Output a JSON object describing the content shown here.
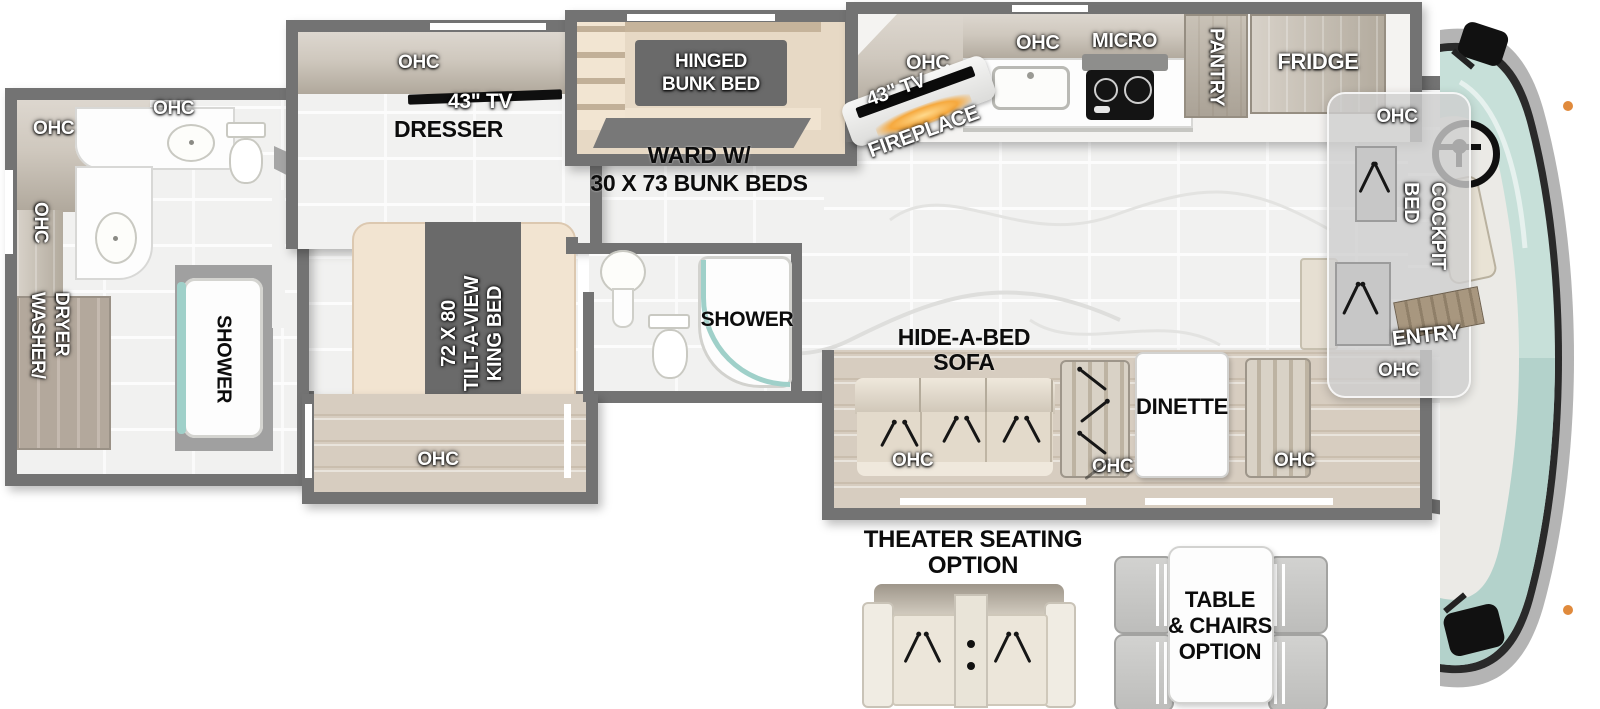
{
  "labels": {
    "ohc": "OHC",
    "tv43": "43\" TV",
    "dresser": "DRESSER",
    "hinged1": "HINGED",
    "hinged2": "BUNK BED",
    "ward1": "WARD W/",
    "ward2": "30 X 73 BUNK BEDS",
    "king1": "72 X 80",
    "king2": "TILT-A-VIEW",
    "king3": "KING BED",
    "shower": "SHOWER",
    "washer1": "WASHER/",
    "washer2": "DRYER",
    "fireplace": "FIREPLACE",
    "micro": "MICRO",
    "pantry": "PANTRY",
    "fridge": "FRIDGE",
    "sofa1": "HIDE-A-BED",
    "sofa2": "SOFA",
    "dinette": "DINETTE",
    "cockpit1": "COCKPIT",
    "cockpit2": "BED",
    "entry": "ENTRY",
    "theater1": "THEATER SEATING",
    "theater2": "OPTION",
    "table1": "TABLE",
    "table2": "& CHAIRS",
    "table3": "OPTION"
  },
  "colors": {
    "wall": "#737373",
    "tile": "#f1f1f0",
    "wood_floor": "#d7cdc0",
    "dark_box": "#6a6a6a",
    "cream": "#f2e4d1",
    "glass_teal": "#9fd0c9",
    "windshield": "#c7e0d9",
    "fire_glow": "#f6a93e",
    "body_gray": "#b4b4b4"
  }
}
